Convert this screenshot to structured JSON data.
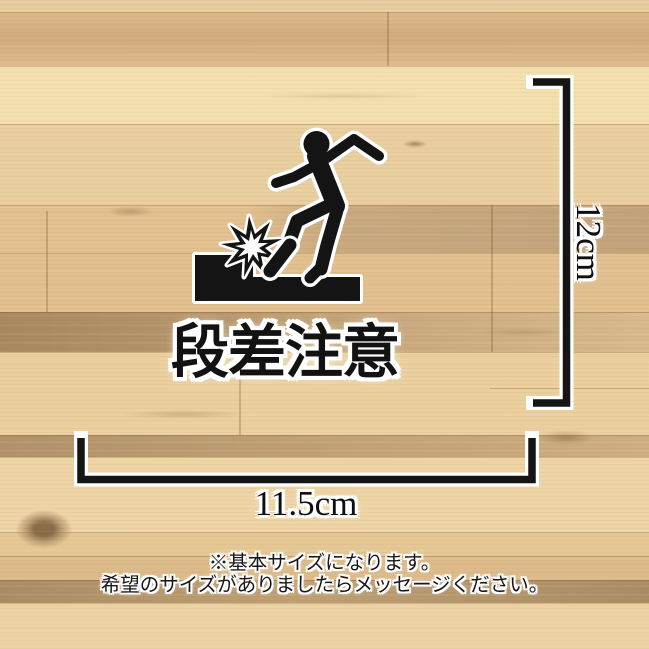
{
  "sticker": {
    "label": "段差注意",
    "pictogram": {
      "person_icon": "person-tripping-icon",
      "step_icon": "step-edge-icon",
      "impact_icon": "impact-burst-icon"
    },
    "ink_color": "#141414",
    "outline_color": "#ffffff"
  },
  "dimensions": {
    "height_label": "12cm",
    "width_label": "11.5cm"
  },
  "note": {
    "line1": "※基本サイズになります。",
    "line2": "希望のサイズがありましたらメッセージください。"
  },
  "background": {
    "type": "wood-planks",
    "tones": [
      "#f3e0ae",
      "#e9cfa0",
      "#e2c08f",
      "#a8885e",
      "#c3a276",
      "#eed4a4"
    ]
  }
}
